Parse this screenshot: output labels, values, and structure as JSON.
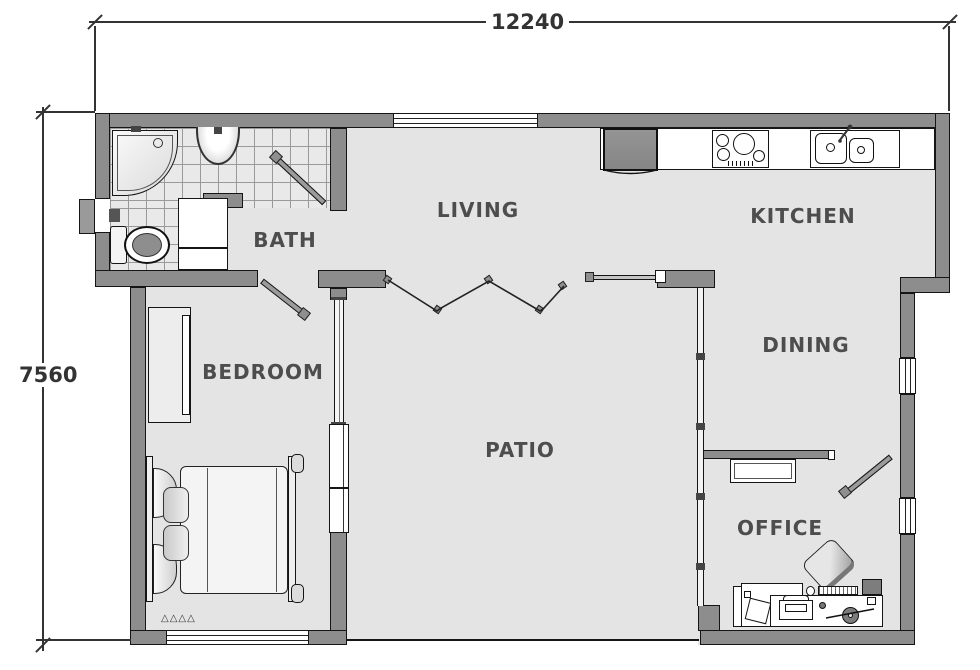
{
  "plan_title": "floor-plan",
  "dimension_labels": {
    "overall_width": "12240",
    "overall_height": "7560"
  },
  "room_labels": {
    "living": "LIVING",
    "kitchen": "KITCHEN",
    "bath": "BATH",
    "bedroom": "BEDROOM",
    "dining": "DINING",
    "patio": "PATIO",
    "office": "OFFICE"
  },
  "decor": {
    "bed_rug_marks": "△△△△"
  },
  "fixture_icons": [
    "corner-shower-icon",
    "bath-sink-icon",
    "toilet-icon",
    "vanity-cabinet-icon",
    "entry-door-icon",
    "bath-door-icon",
    "bedroom-door-icon",
    "office-door-icon",
    "bifold-door-icon",
    "sliding-door-icon",
    "bedroom-sliding-door-icon",
    "fridge-icon",
    "cooktop-icon",
    "double-sink-icon",
    "kitchen-counter-icon",
    "wardrobe-icon",
    "double-bed-icon",
    "office-desk-icon",
    "office-chair-icon",
    "printer-icon",
    "pc-tower-icon",
    "keyboard-icon",
    "mouse-icon",
    "tape-dispenser-icon",
    "office-cabinet-icon",
    "paper-sheet-icon"
  ],
  "colors": {
    "wall_fill": "#8d8d8d",
    "floor_fill": "#e4e4e4",
    "outline": "#151515",
    "label_text": "#4d4d4d",
    "dimension_text": "#333333"
  }
}
